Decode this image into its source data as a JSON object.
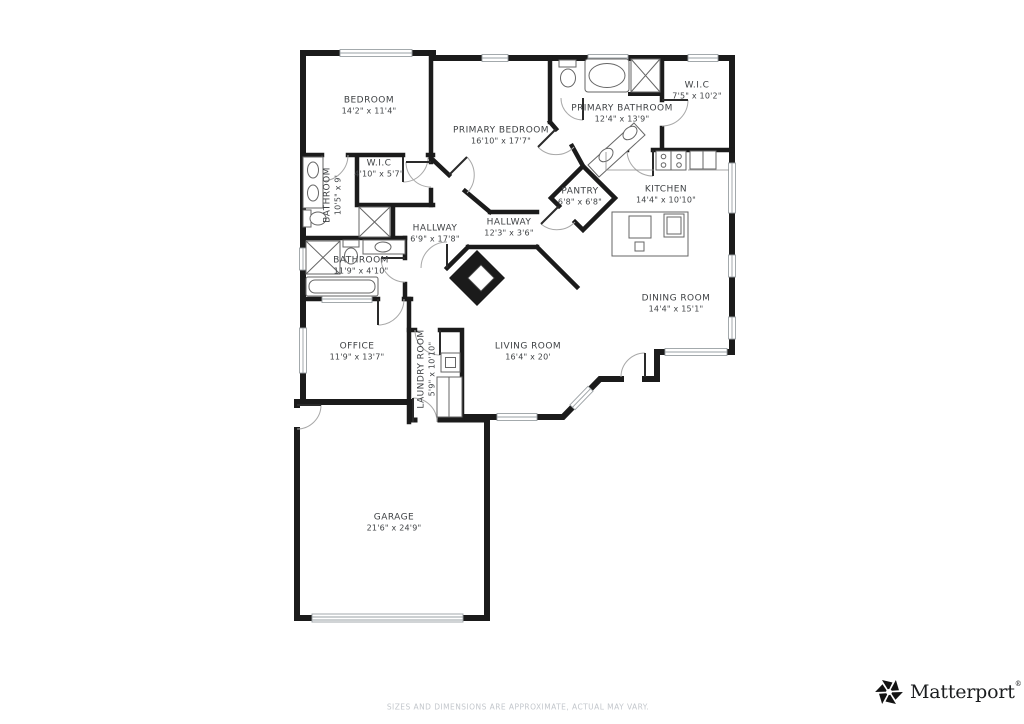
{
  "page": {
    "background_color": "#ffffff"
  },
  "plan": {
    "wall_color": "#1b1b1b",
    "door_arc_color": "#a8a8a8",
    "fixture_color": "#666666",
    "label_color": "#3f4245",
    "rooms": [
      {
        "id": "bedroom",
        "name": "BEDROOM",
        "dims": "14'2\" x 11'4\""
      },
      {
        "id": "primary-bedroom",
        "name": "PRIMARY BEDROOM",
        "dims": "16'10\" x 17'7\""
      },
      {
        "id": "primary-bathroom",
        "name": "PRIMARY BATHROOM",
        "dims": "12'4\" x 13'9\""
      },
      {
        "id": "wic-primary",
        "name": "W.I.C",
        "dims": "7'5\" x 10'2\""
      },
      {
        "id": "wic-bedroom",
        "name": "W.I.C",
        "dims": "4'10\" x 5'7\""
      },
      {
        "id": "bathroom-1",
        "name": "BATHROOM",
        "dims": "10'5\" x 9'"
      },
      {
        "id": "hallway-1",
        "name": "HALLWAY",
        "dims": "6'9\" x 17'8\""
      },
      {
        "id": "hallway-2",
        "name": "HALLWAY",
        "dims": "12'3\" x 3'6\""
      },
      {
        "id": "pantry",
        "name": "PANTRY",
        "dims": "6'8\" x 6'8\""
      },
      {
        "id": "kitchen",
        "name": "KITCHEN",
        "dims": "14'4\" x 10'10\""
      },
      {
        "id": "bathroom-2",
        "name": "BATHROOM",
        "dims": "11'9\" x 4'10\""
      },
      {
        "id": "dining-room",
        "name": "DINING ROOM",
        "dims": "14'4\" x 15'1\""
      },
      {
        "id": "office",
        "name": "OFFICE",
        "dims": "11'9\" x 13'7\""
      },
      {
        "id": "laundry-room",
        "name": "LAUNDRY ROOM",
        "dims": "5'9\" x 10'10\""
      },
      {
        "id": "living-room",
        "name": "LIVING ROOM",
        "dims": "16'4\" x 20'"
      },
      {
        "id": "garage",
        "name": "GARAGE",
        "dims": "21'6\" x 24'9\""
      }
    ]
  },
  "footer": {
    "disclaimer": "SIZES AND DIMENSIONS ARE APPROXIMATE, ACTUAL MAY VARY.",
    "brand_name": "Matterport",
    "brand_mark": "®"
  }
}
